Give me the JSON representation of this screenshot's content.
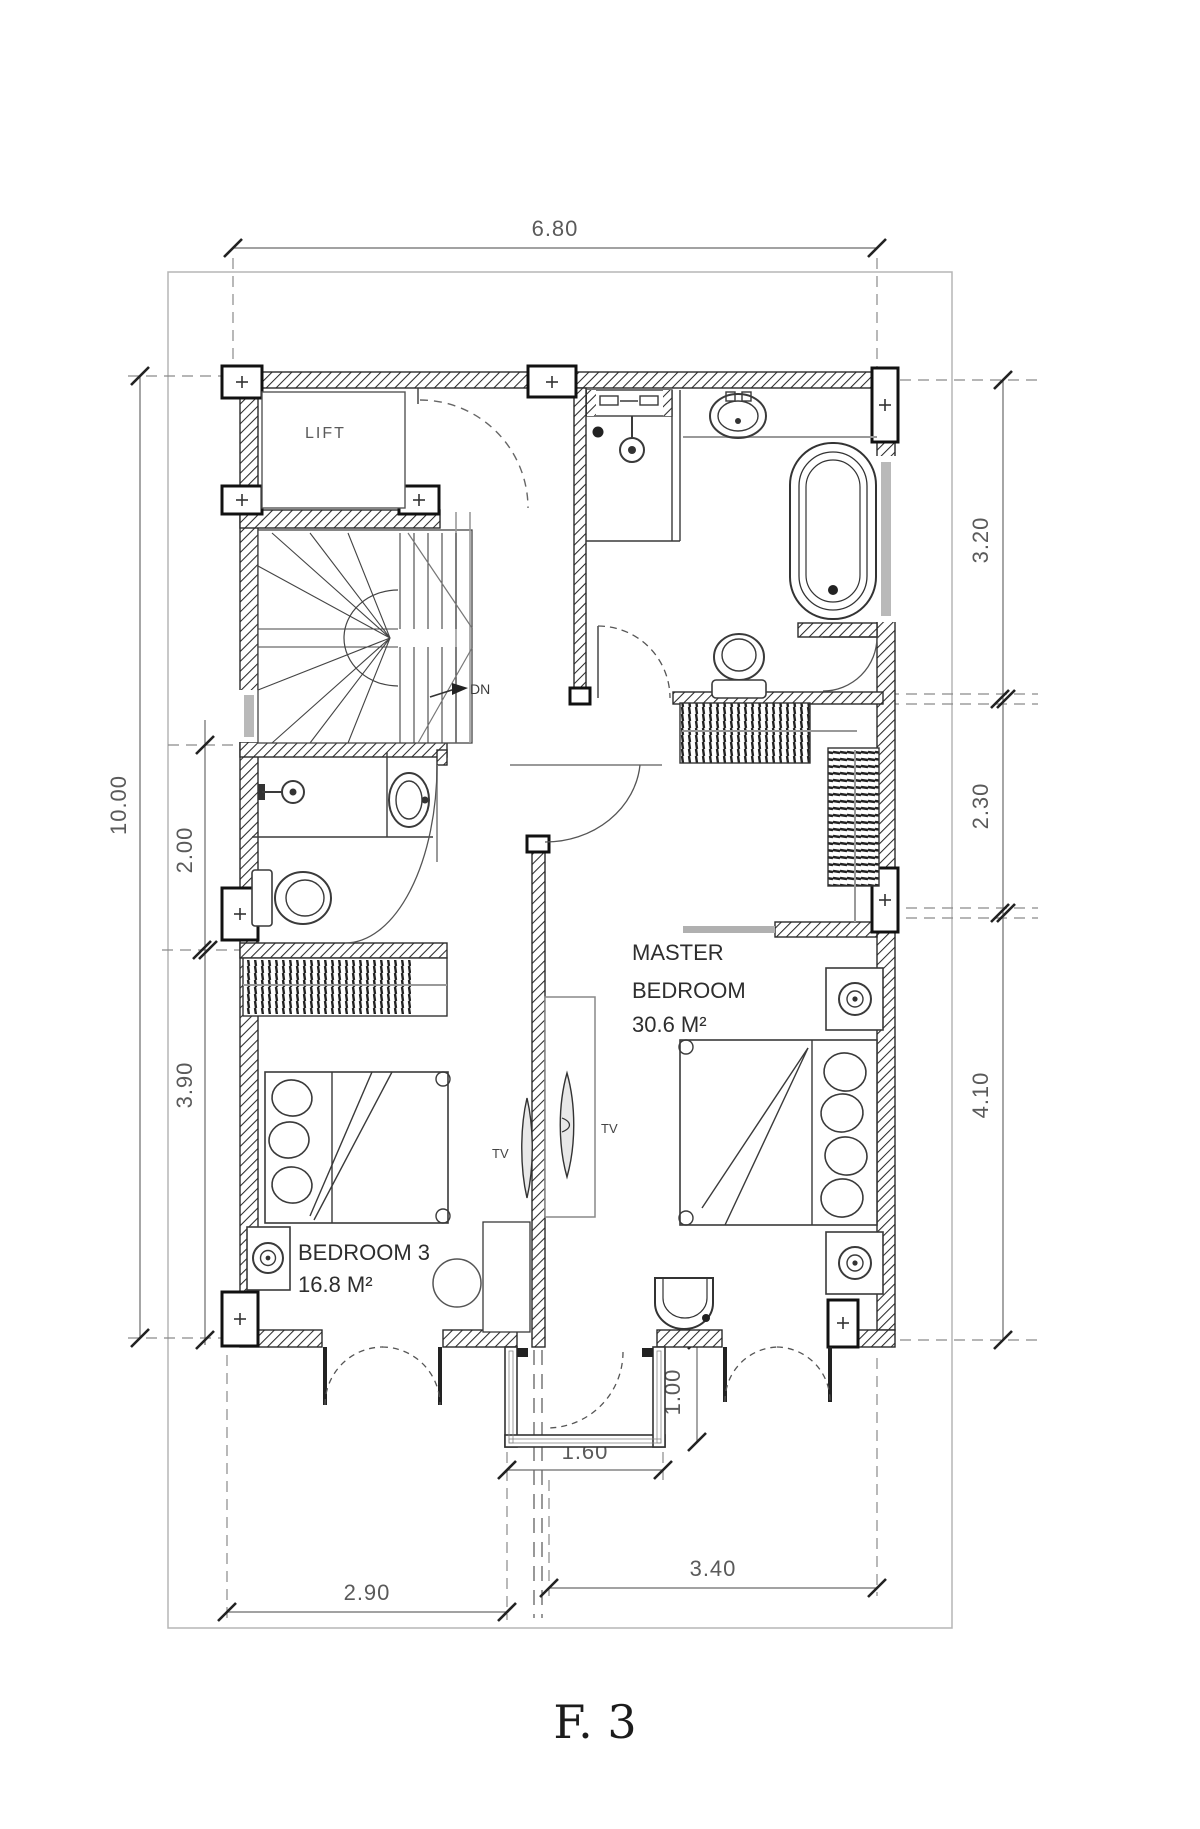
{
  "drawing": {
    "title": "F. 3",
    "rooms": {
      "lift": "LIFT",
      "stairs_direction": "DN",
      "master_bedroom": {
        "line1": "MASTER",
        "line2": "BEDROOM",
        "area": "30.6 M²"
      },
      "bedroom3": {
        "name": "BEDROOM 3",
        "area": "16.8 M²"
      },
      "tv_master": "TV",
      "tv_bedroom3": "TV"
    },
    "dimensions": {
      "top_width": "6.80",
      "left_total": "10.00",
      "left_bath": "2.00",
      "left_bedroom3": "3.90",
      "right_bathroom": "3.20",
      "right_closet": "2.30",
      "right_master": "4.10",
      "bottom_bedroom3": "2.90",
      "balcony_width": "1.60",
      "bottom_master": "3.40",
      "balcony_depth": "1.00"
    },
    "colors": {
      "ink": "#2b2b2b",
      "dim_text": "#5a5a5a",
      "window_fill": "#b9b9b9",
      "light_line": "#999999",
      "frame": "#b5b5b5"
    }
  }
}
